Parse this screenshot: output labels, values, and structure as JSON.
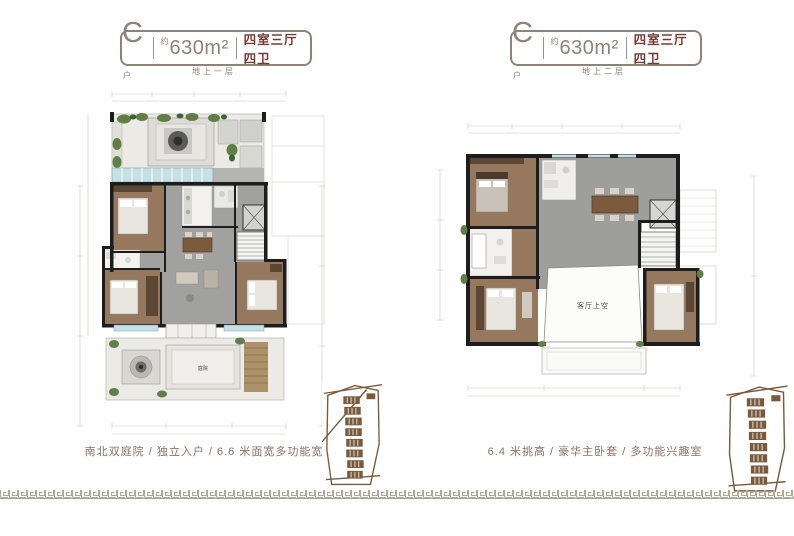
{
  "colors": {
    "badge_frame": "#8f8278",
    "layout_red": "#7a3a33",
    "caption_brown": "#8a7264",
    "keyplan_brown": "#7a5a3c",
    "meander_tan": "#b3a896",
    "wall_black": "#1d1d1d",
    "wood_floor": "#96785e",
    "stone_gray": "#a1a19f",
    "window_blue": "#c7e0e6",
    "courtyard_light": "#eceae5",
    "plant_green": "#5f7f47"
  },
  "panels": [
    {
      "badge": {
        "unit": "C",
        "unit_sub": "户",
        "approx": "约",
        "area": "630m²",
        "layout": "四室三厅四卫"
      },
      "floor_label": "地上一层",
      "caption": "南北双庭院 / 独立入户 / 6.6 米面宽多功能宽厅",
      "labels": {
        "courtyard": "庭院"
      }
    },
    {
      "badge": {
        "unit": "C",
        "unit_sub": "户",
        "approx": "约",
        "area": "630m²",
        "layout": "四室三厅四卫"
      },
      "floor_label": "地上二层",
      "caption": "6.4 米挑高 / 豪华主卧套 / 多功能兴趣室",
      "labels": {
        "void": "客厅上空"
      }
    }
  ]
}
